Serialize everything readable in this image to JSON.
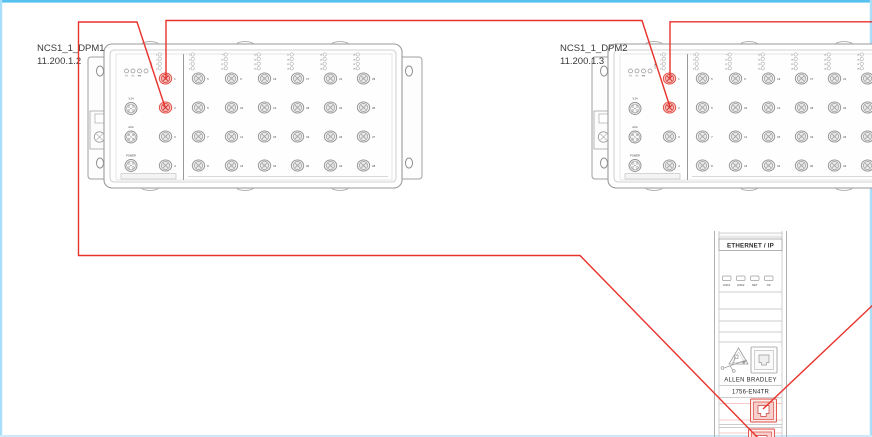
{
  "diagram": {
    "devices": [
      {
        "name": "NCS1_1_DPM1",
        "ip": "11.200.1.2"
      },
      {
        "name": "NCS1_1_DPM2",
        "ip": "11.200.1.3"
      }
    ],
    "switch_template": {
      "port_count": 28,
      "status_led_labels": [
        "P1",
        "P2",
        "RM",
        "FAULT"
      ],
      "connector_labels": [
        "V.24",
        "ACA",
        "POWER"
      ],
      "highlighted_ports": [
        1,
        2
      ]
    },
    "controller": {
      "header": "ETHERNET / IP",
      "led_labels": [
        "LINK1",
        "LINK2",
        "NET",
        "OK"
      ],
      "brand": "ALLEN BRADLEY",
      "model": "1756-EN4TR",
      "highlighted_ports": [
        "top-rj45",
        "bottom-rj45"
      ]
    },
    "connections": [
      {
        "from": "NCS1_1_DPM1 port 1",
        "to": "NCS1_1_DPM2 port 2"
      },
      {
        "from": "NCS1_1_DPM1 port 2",
        "to": "1756-EN4TR bottom port"
      },
      {
        "from": "NCS1_1_DPM2 port 1",
        "to": "1756-EN4TR top port (runs off right edge)"
      }
    ],
    "colors": {
      "connection_line": "#e8322b",
      "port_highlight_fill": "#f6b5b2",
      "port_highlight_stroke": "#da3b33",
      "border_top": "#56c0ef",
      "border_side": "#a9def8"
    }
  }
}
